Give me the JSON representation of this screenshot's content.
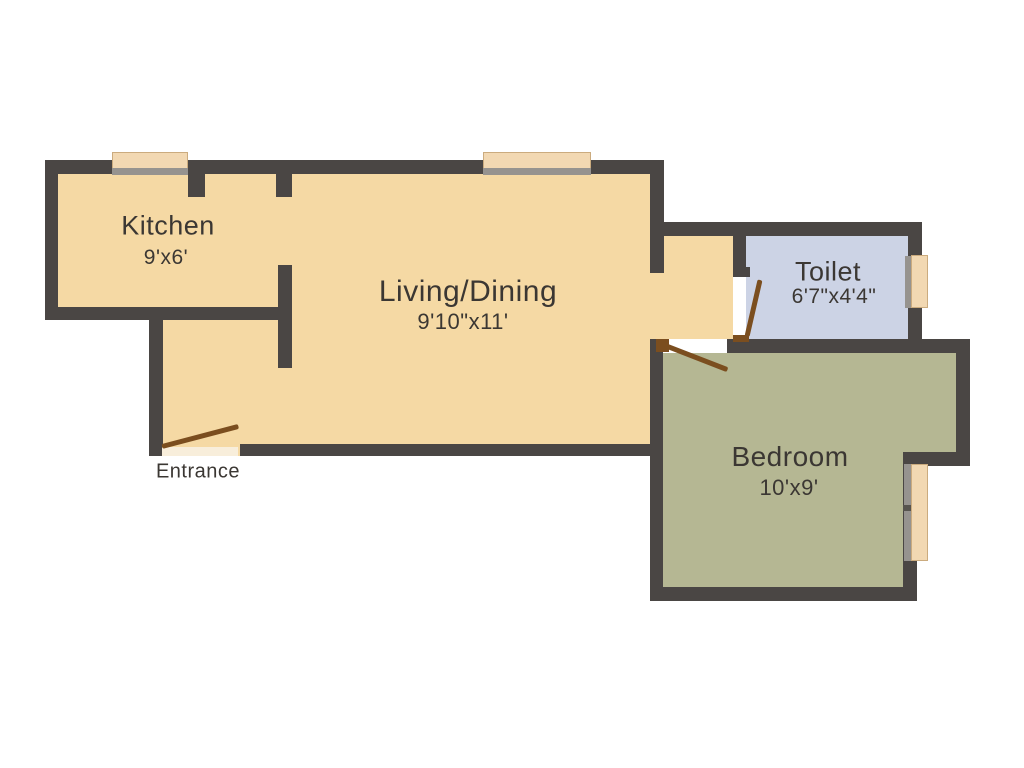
{
  "plan_title": "1BHK Floor Plan",
  "rooms": {
    "kitchen": {
      "label": "Kitchen",
      "dims": "9'x6'"
    },
    "living_dining": {
      "label": "Living/Dining",
      "dims": "9'10\"x11'"
    },
    "toilet": {
      "label": "Toilet",
      "dims": "6'7\"x4'4\""
    },
    "bedroom": {
      "label": "Bedroom",
      "dims": "10'x9'"
    }
  },
  "entrance": {
    "label": "Entrance"
  },
  "colors": {
    "background": "#ffffff",
    "wall": "#4a4644",
    "floor_main": "#f5d9a4",
    "floor_toilet": "#ccd3e5",
    "floor_bedroom": "#b5b793",
    "door": "#7b4e1f",
    "window": "#f2d8b2",
    "window_frame": "#96938f",
    "threshold": "#f8eedb",
    "text": "#3b3733"
  }
}
